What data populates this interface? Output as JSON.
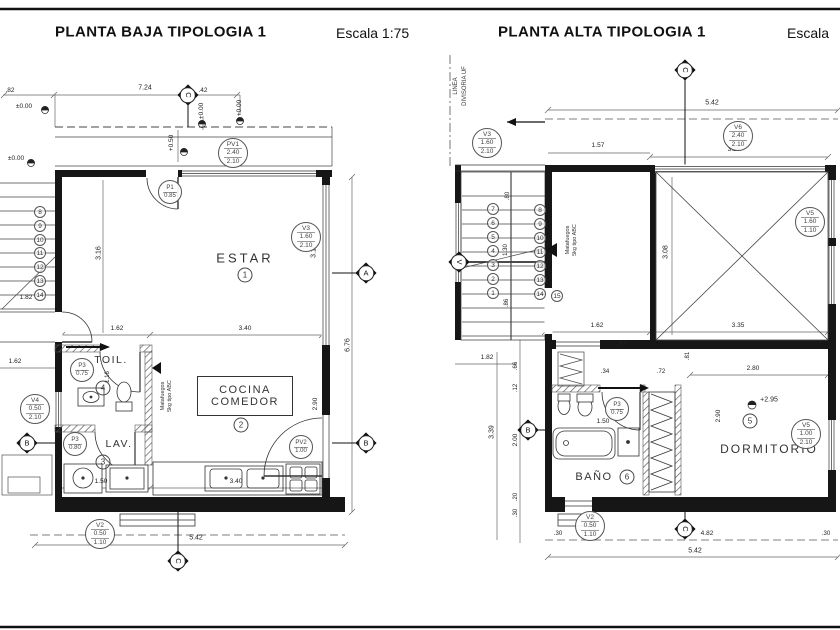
{
  "left": {
    "title": "PLANTA BAJA TIPOLOGIA 1",
    "scale": "Escala 1:75",
    "dims": {
      "w_total": "7.24",
      "w_left": ".82",
      "w_right": ".42",
      "stair": "1.82",
      "estar_h": "3.16",
      "win_h": "3.16",
      "toil_w": "1.62",
      "cocina_w": "3.40",
      "total_h": "6.76",
      "pv2_h": "2.90",
      "toil_h": "1.16",
      "lav_w": "1.50",
      "counter_w": "3.40",
      "bottom": "5.42",
      "edge": "1.62"
    },
    "levels": {
      "a": "±0.00",
      "b": "±0.00",
      "c": "+0.00",
      "d": "+0.00",
      "e": "+0.50"
    },
    "steps": [
      "8",
      "9",
      "10",
      "11",
      "12",
      "13",
      "14"
    ],
    "rooms": {
      "estar": "ESTAR",
      "estar_n": "1",
      "cocina1": "COCINA",
      "cocina2": "COMEDOR",
      "cocina_n": "2",
      "lav": "LAV.",
      "lav_n": "3",
      "toil": "TOIL.",
      "toil_n": "4"
    },
    "note1": "Matafuegos",
    "note2": "5kg tipo ABC",
    "tags": {
      "pv1": [
        "PV1",
        "2.40",
        "2.10"
      ],
      "p1": [
        "P1",
        "0.85"
      ],
      "v3": [
        "V3",
        "1.60",
        "2.10"
      ],
      "v4": [
        "V4",
        "0.50",
        "2.10"
      ],
      "pv2": [
        "PV2",
        "1.00"
      ],
      "p3t": [
        "P3",
        "0.75"
      ],
      "p3l": [
        "P3",
        "0.80"
      ],
      "v2": [
        "V2",
        "0.50",
        "1.10"
      ]
    },
    "markers": {
      "a": "A",
      "b": "B",
      "bl": "B",
      "ct": "C",
      "cb": "C"
    }
  },
  "right": {
    "title": "PLANTA ALTA TIPOLOGIA 1",
    "scale": "Escala",
    "divisoria1": "LINEA",
    "divisoria2": "DIVISORIA UF",
    "dims": {
      "top": "5.42",
      "d157": "1.57",
      "d325": "3.25",
      "s80": ".80",
      "s130": "1.30",
      "s86": ".86",
      "d308": "3.08",
      "d162": "1.62",
      "d335": "3.35",
      "d182": "1.82",
      "d66": ".66",
      "d12": ".12",
      "d200": "2.00",
      "d20": ".20",
      "d30": ".30",
      "d339": "3.39",
      "d87": ".87",
      "d34": ".34",
      "d72": ".72",
      "d81": ".81",
      "d150": "1.50",
      "d280": "2.80",
      "d290": "2.90",
      "b30l": ".30",
      "b482": "4.82",
      "b30r": ".30",
      "bottom": "5.42"
    },
    "level": "+2.95",
    "steps_a": [
      "1",
      "2",
      "3",
      "4",
      "5",
      "6",
      "7"
    ],
    "steps_b": [
      "8",
      "9",
      "10",
      "11",
      "12",
      "13",
      "14"
    ],
    "step15": "15",
    "rooms": {
      "dorm": "DORMITORIO",
      "dorm_n": "5",
      "bano": "BAÑO",
      "bano_n": "6"
    },
    "note1": "Matafuegos",
    "note2": "5kg tipo ABC",
    "tags": {
      "v3": [
        "V3",
        "1.60",
        "2.10"
      ],
      "v6": [
        "V6",
        "2.40",
        "2.10"
      ],
      "v5t": [
        "V5",
        "1.60",
        "1.10"
      ],
      "v5r": [
        "V5",
        "1.00",
        "2.10"
      ],
      "p3": [
        "P3",
        "0.75"
      ],
      "v2": [
        "V2",
        "0.50",
        "1.10"
      ]
    },
    "markers": {
      "v": "V",
      "b": "B",
      "ct": "C",
      "cb": "C"
    }
  }
}
